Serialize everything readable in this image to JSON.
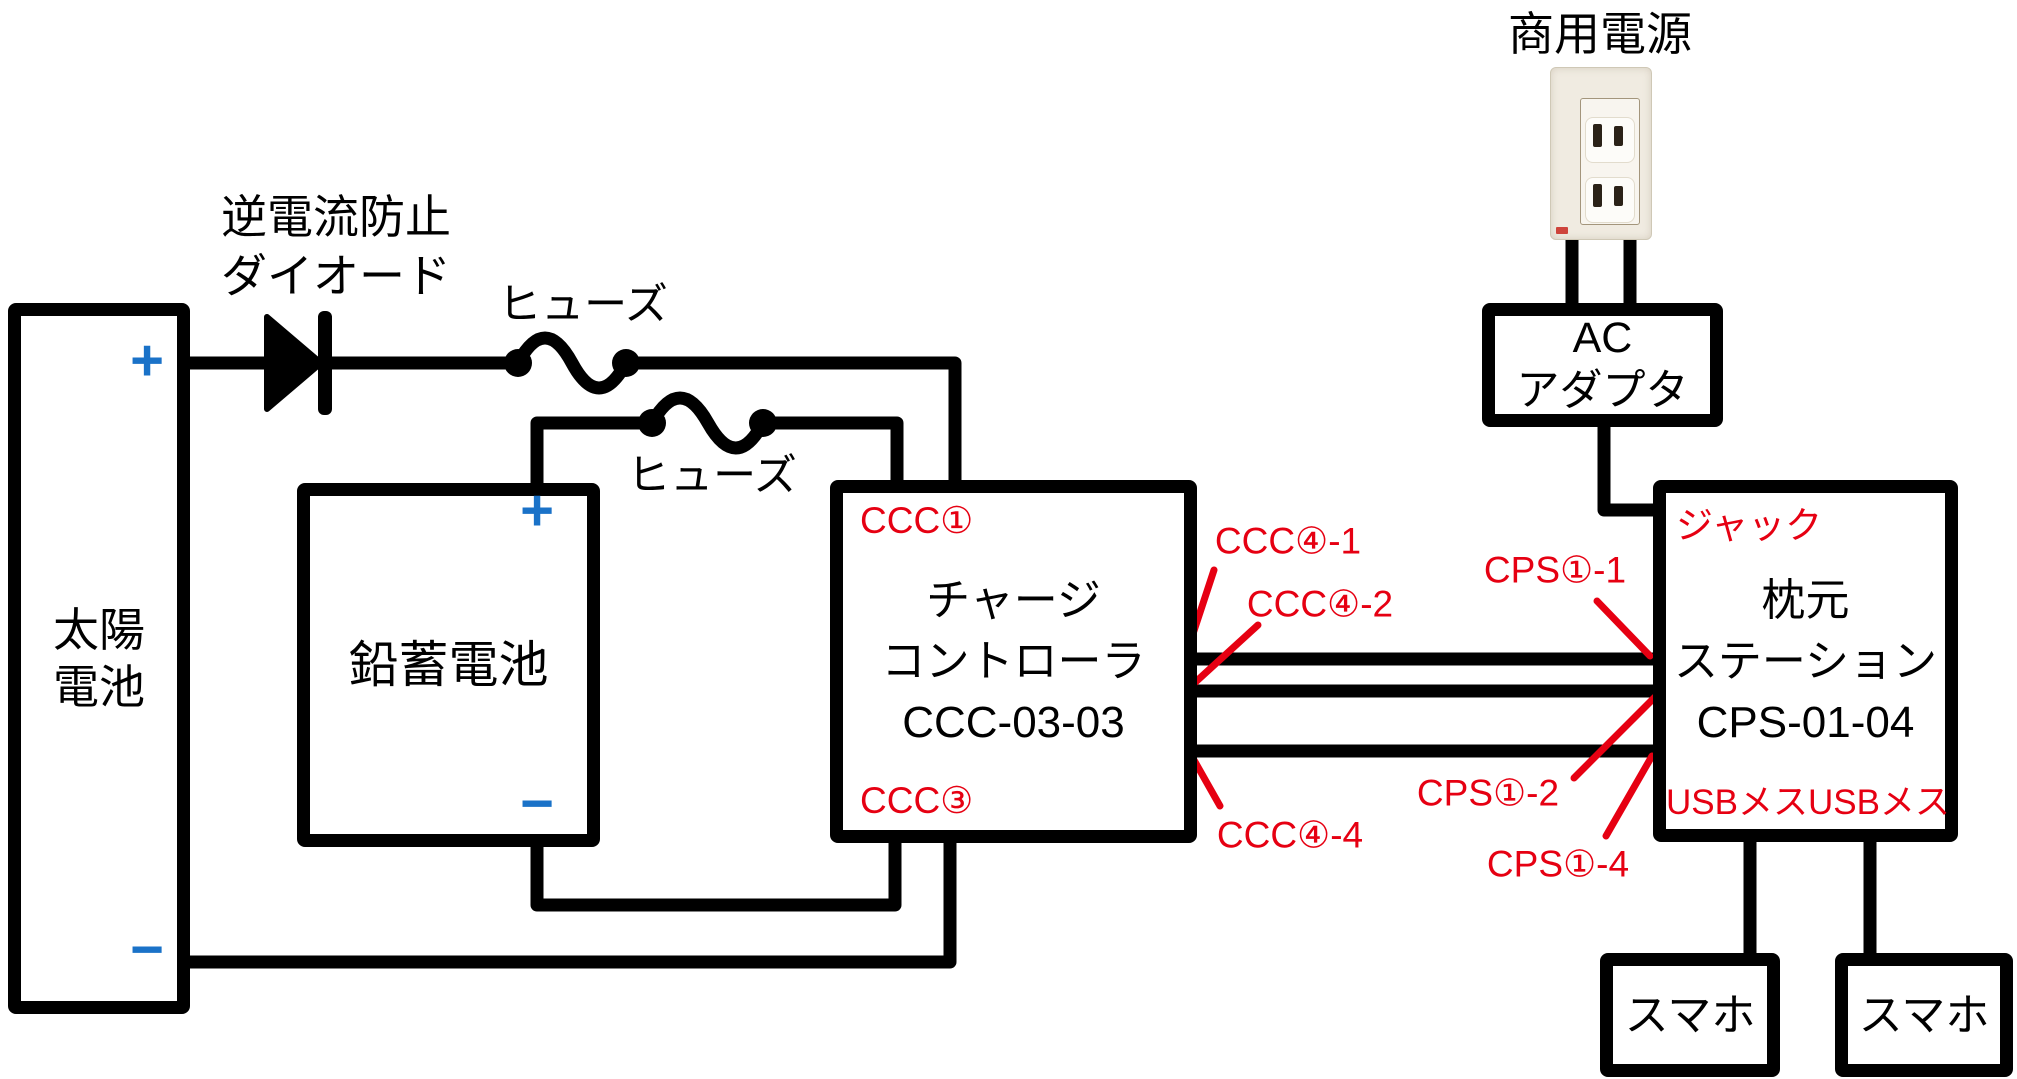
{
  "page": {
    "background": "#ffffff"
  },
  "colors": {
    "wire": "#000000",
    "annotation_red": "#e60012",
    "polarity_blue": "#1a72c8"
  },
  "labels": {
    "commercial_power": "商用電源",
    "reverse_current_diode_line1": "逆電流防止",
    "reverse_current_diode_line2": "ダイオード",
    "fuse_top": "ヒューズ",
    "fuse_battery": "ヒューズ"
  },
  "components": {
    "solar_battery": {
      "name_line1": "太陽",
      "name_line2": "電池",
      "plus": "+",
      "minus": "−"
    },
    "lead_acid_battery": {
      "name": "鉛蓄電池",
      "plus": "+",
      "minus": "−"
    },
    "charge_controller": {
      "name_line1": "チャージ",
      "name_line2": "コントローラ",
      "model": "CCC-03-03",
      "terminal_top": "CCC①",
      "terminal_bottom": "CCC③"
    },
    "bedside_station": {
      "name_line1": "枕元",
      "name_line2": "ステーション",
      "model": "CPS-01-04",
      "jack": "ジャック",
      "usb_ports": "USBメスUSBメス"
    },
    "ac_adapter": {
      "line1": "AC",
      "line2": "アダプタ"
    },
    "smartphone_left": {
      "name": "スマホ"
    },
    "smartphone_right": {
      "name": "スマホ"
    }
  },
  "annotations": {
    "ccc4_1": "CCC④-1",
    "ccc4_2": "CCC④-2",
    "ccc4_4": "CCC④-4",
    "cps1_1": "CPS①-1",
    "cps1_2": "CPS①-2",
    "cps1_4": "CPS①-4"
  }
}
